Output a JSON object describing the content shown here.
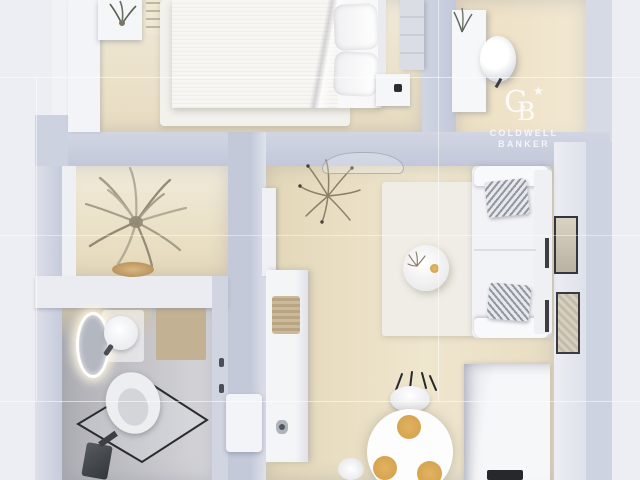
{
  "watermark": {
    "monogram": {
      "c": "C",
      "b": "B",
      "star": "★"
    },
    "brand_line1": "COLDWELL",
    "brand_line2": "BANKER"
  },
  "scene": {
    "type": "3d-rendered-floor-plan-top-view",
    "rooms": [
      {
        "name": "bedroom",
        "position": "top-left",
        "furniture": [
          "wardrobe",
          "shelf-with-plant",
          "ladder-shelf",
          "double-bed-white-duvet",
          "pillows",
          "nightstand-with-clock",
          "dresser",
          "white-area-rug"
        ]
      },
      {
        "name": "office-nook",
        "position": "top-right",
        "furniture": [
          "white-desk",
          "desk-plant",
          "white-office-chair"
        ]
      },
      {
        "name": "hallway",
        "position": "middle-left",
        "furniture": [
          "palm-plant",
          "wooden-bowl"
        ]
      },
      {
        "name": "living-room",
        "position": "middle-right",
        "furniture": [
          "white-sofa",
          "patterned-cushions",
          "round-coffee-table",
          "cream-rug",
          "dried-branch-plant",
          "glass-console",
          "tall-white-cabinet",
          "wall-art-frames",
          "leaning-art-panels"
        ]
      },
      {
        "name": "dining-area",
        "position": "bottom-center",
        "furniture": [
          "round-white-table",
          "gold-place-settings",
          "chair-with-black-legs",
          "second-chair",
          "white-sideboard-with-basket",
          "door-panel"
        ]
      },
      {
        "name": "kitchen",
        "position": "bottom-right",
        "furniture": [
          "white-counter-unit",
          "dark-cooktop"
        ]
      },
      {
        "name": "bathroom",
        "position": "bottom-left",
        "furniture": [
          "led-ring-mirror",
          "round-washbasin",
          "toilet",
          "glass-shower-screen",
          "dark-shower-column",
          "tan-bath-mat"
        ]
      }
    ]
  },
  "colors": {
    "page_background": "#edeef4",
    "wall_blue_gray": "#c6ccdd",
    "wall_white": "#eceef3",
    "wood_floor": "#e9dfc4",
    "bathroom_floor_gray": "#c2c2c8",
    "gold_accent": "#d9a94f",
    "watermark": "#ffffff"
  }
}
